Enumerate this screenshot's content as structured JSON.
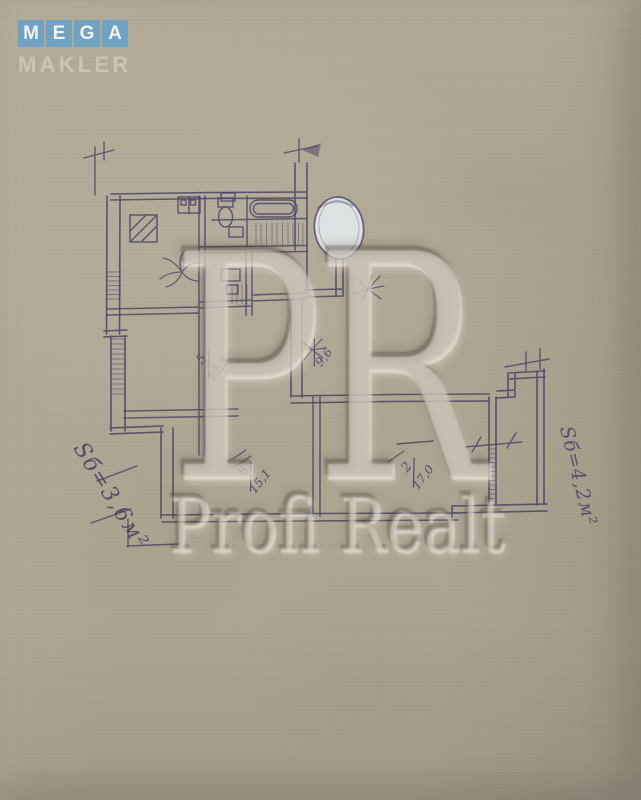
{
  "logo": {
    "letters": [
      "M",
      "E",
      "G",
      "A"
    ],
    "subtitle": "MAKLER"
  },
  "watermark": {
    "monogram": [
      "P",
      "R"
    ],
    "brand": "Profi Realt"
  },
  "plan": {
    "room_labels": [
      {
        "number": "5",
        "area": "12,3"
      },
      {
        "number": "4",
        "area": "9,6"
      },
      {
        "number": "6",
        "area": "15,1"
      },
      {
        "number": "2",
        "area": "17,0"
      }
    ],
    "balcony_left": "Sб=3,6м²",
    "balcony_right": "Sб=4,2м²"
  },
  "colors": {
    "paper": "#ada491",
    "ink": "#474063",
    "logo_blue": "#6aa2c4",
    "logo_letter": "#f1f2ed",
    "logo_subtitle": "#ccc6b8",
    "whiteout_oval": "#dde3e2"
  }
}
